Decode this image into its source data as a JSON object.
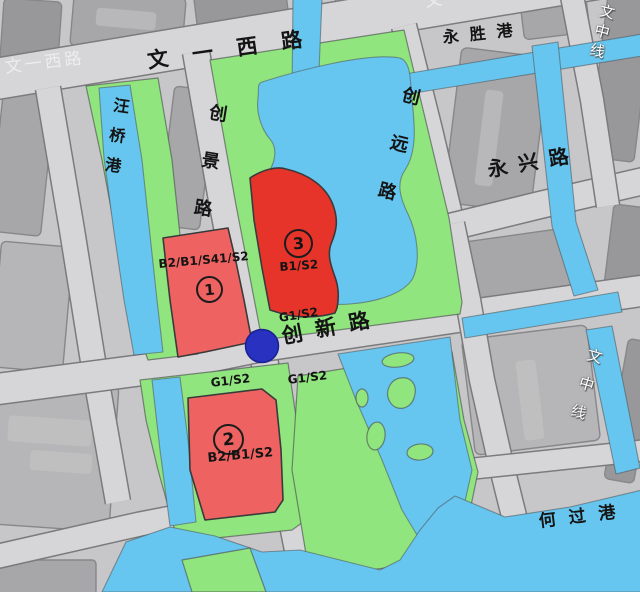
{
  "map_type": "urban-planning-map",
  "roads": {
    "wenyi_west": "文一西路",
    "chuangjing": "创景路",
    "chuangyuan": "创远路",
    "yongxing": "永兴路",
    "chuangxin": "创新路",
    "wenzhong_line": "文中线"
  },
  "waterways": {
    "wangqiao": "汪桥港",
    "yongsheng": "永胜港",
    "heguo": "何过港"
  },
  "zones": [
    {
      "number": "1",
      "code": "B2/B1/S41/S2"
    },
    {
      "number": "2",
      "code": "B2/B1/S2"
    },
    {
      "number": "3",
      "code": "B1/S2"
    }
  ],
  "green_zone_label": "G1/S2",
  "colors": {
    "bg": "#c7c6c8",
    "block": "#a7a7a9",
    "block_light": "#b6b5b7",
    "block_dark": "#98989a",
    "block_edge": "#87878a",
    "road_fill": "#d6d5d7",
    "road_edge": "#7b7b7d",
    "green": "#90e57e",
    "water": "#66c6ef",
    "red_bright": "#e7342b",
    "red_soft": "#ee6361",
    "shape_edge": "#4f5054",
    "station": "#2831c0",
    "label": "#141414"
  }
}
